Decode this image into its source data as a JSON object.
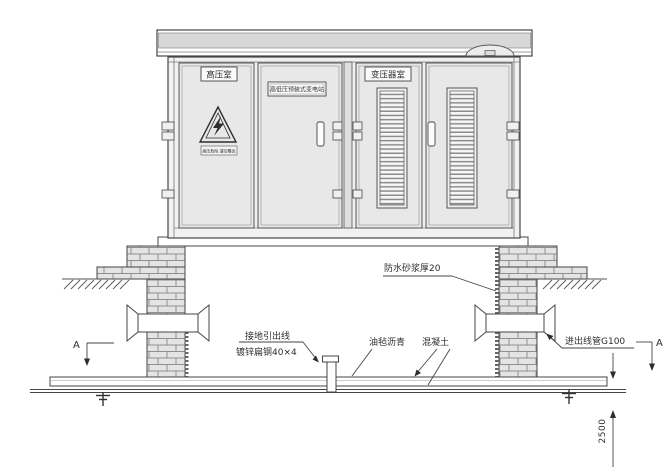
{
  "drawing_type": "substation-foundation-elevation",
  "cabinet": {
    "door_labels": {
      "high_voltage_room": "高压室",
      "nameplate": "高低压预装式变电站",
      "transformer_room": "变压器室"
    },
    "warning_sign_text": "高压危险 请勿靠近"
  },
  "annotations": {
    "waterproof_mortar": "防水砂浆厚20",
    "ground_lead_line1": "接地引出线",
    "ground_lead_line2": "镀锌扁钢40×4",
    "asphalt_felt": "油毡沥青",
    "concrete": "混凝土",
    "inlet_outlet_conduit": "进出线管G100",
    "section_marker_left": "A",
    "section_marker_right": "A",
    "dimension_vertical": "2500"
  },
  "colors": {
    "line": "#454545",
    "door_fill": "#e8e8e8",
    "roof_band": "#d8d8d8",
    "brick_fill": "#e4e4e4",
    "brick_joint": "#8f8f8f",
    "louver_slat": "#8c8c8c"
  }
}
